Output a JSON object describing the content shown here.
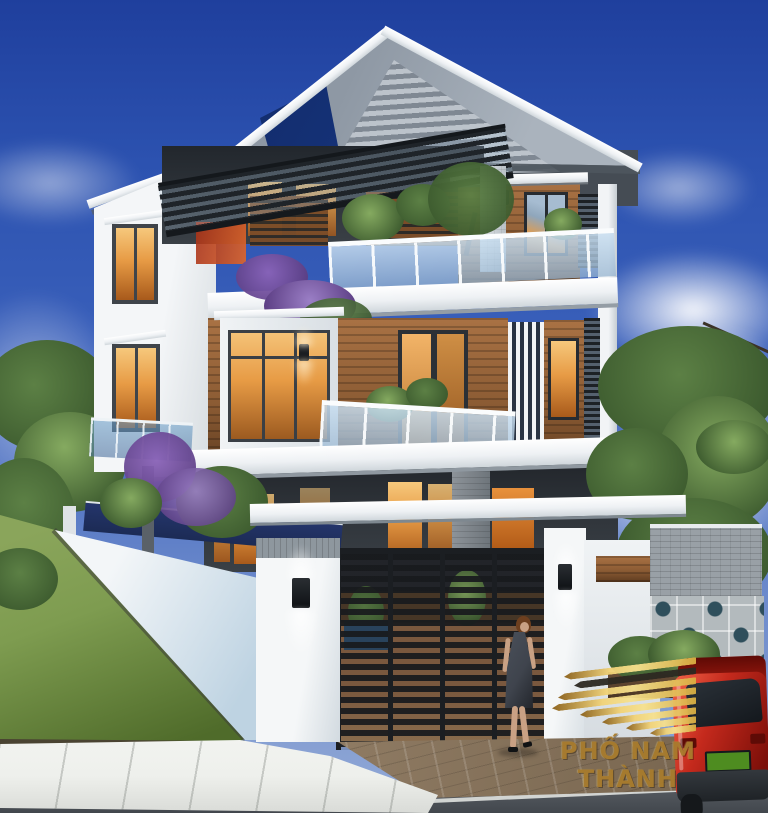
{
  "scene": {
    "description": "Photorealistic 3D exterior rendering of a modern three-storey villa at dusk: grey gable roof, white and wood-clad facades, glass balconies with plants, dark metal pergola, white perimeter fence with lit gate pillars, black slatted gate, lawn, sidewalk and road, a woman walking by the gate, a red SUV at lower right, trees and a blue sky with clouds",
    "setting": "residential street corner lot"
  },
  "watermark": {
    "brand_line": "PHỐ NAM THÀNH",
    "logo": "gold-layered-building-logo"
  },
  "palette": {
    "sky_top": "#1f3f9d",
    "sky_mid": "#3c62bc",
    "sky_low": "#93aad6",
    "roof_gray": "#8e98a4",
    "roof_gray_light": "#aab3bd",
    "roof_shadow": "#4e565e",
    "roof_navy": "#17357e",
    "fascia": "#eef1f4",
    "wall_white": "#eff2f4",
    "wall_shadow": "#c9d0d6",
    "wood_light": "#a97244",
    "wood": "#8c5c34",
    "wood_dark": "#5f3c20",
    "charcoal": "#2f343a",
    "charcoal_deep": "#1d2125",
    "warm": "#e79b45",
    "warm_deep": "#a85a1b",
    "glass": "#bcd2e6",
    "glass_teal": "#6f9cc0",
    "leaf": "#5c8045",
    "leaf_dark": "#3c5a2e",
    "leaf_light": "#85aa60",
    "purple": "#8a63b8",
    "purple_dark": "#5d3f85",
    "lawn": "#7e9c50",
    "lawn_dark": "#4f6b2a",
    "fence_light": "#f3f6f8",
    "fence_shade": "#bed3e2",
    "navy_wall": "#1c2b55",
    "gate": "#202428",
    "deck": "#8a6243",
    "deck_dark": "#4e3a28",
    "brick": "#99a0a6",
    "breeze_bg": "#b3babd",
    "breeze_hole": "#2f4f5c",
    "paver": "#8f7b63",
    "paver_dark": "#74624c",
    "sidewalk": "#eef0ec",
    "road": "#51565c",
    "line": "#e9ebe7",
    "car_red": "#c52a1d",
    "car_red_dark": "#7c0f09",
    "car_glass": "#14181d",
    "car_bumper": "#33383d",
    "plate": "#4e8c20",
    "skin": "#c9a184",
    "hair": "#6d3f1f",
    "dress": "#3f444d",
    "gold": "#d9ae41",
    "gold_light": "#f2d377",
    "gold_deep": "#8a5f18",
    "logo_black": "#2d2922",
    "text_gold": "#a87b2d"
  }
}
